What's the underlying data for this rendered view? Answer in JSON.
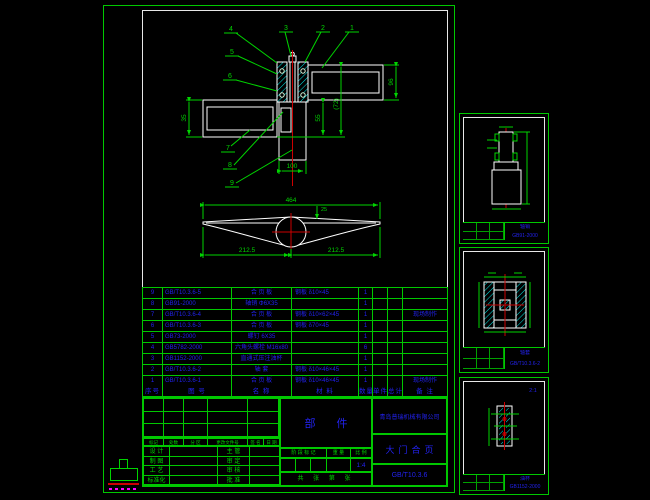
{
  "colors": {
    "background": "#000000",
    "frame_green": "#00c800",
    "annotation_green": "#00d400",
    "geometry_white": "#ffffff",
    "hatch_cyan": "#00e5e5",
    "centerline_red": "#cc0000",
    "table_text_blue": "#2222ee",
    "stamp_magenta": "#ff00ff"
  },
  "main_sheet": {
    "assembly": {
      "callouts": [
        "1",
        "2",
        "3",
        "4",
        "5",
        "6",
        "7",
        "8",
        "9"
      ],
      "dims": {
        "right_bar": "96",
        "overall": "(72)",
        "column": "55",
        "left_bar": "35",
        "bottom": "100"
      }
    },
    "profile": {
      "dims": {
        "overall": "464",
        "offset": "25",
        "half_left": "212.5",
        "half_right": "212.5"
      }
    },
    "parts_table": {
      "headers": [
        "序号",
        "图  号",
        "名  称",
        "材  料",
        "数量",
        "单件",
        "总计",
        "备  注"
      ],
      "rows": [
        {
          "no": "9",
          "code": "GB/T10.3.6-5",
          "name": "合 页 板",
          "material": "钢板  δ10×45",
          "qty": "1",
          "w1": "",
          "w2": "",
          "remark": ""
        },
        {
          "no": "8",
          "code": "GB91-2000",
          "name": "轴销  Φ6X35",
          "material": "",
          "qty": "1",
          "w1": "",
          "w2": "",
          "remark": ""
        },
        {
          "no": "7",
          "code": "GB/T10.3.6-4",
          "name": "合 页 板",
          "material": "钢板  δ10×62×45",
          "qty": "1",
          "w1": "",
          "w2": "",
          "remark": "现场制作"
        },
        {
          "no": "6",
          "code": "GB/T10.3.6-3",
          "name": "合 页 板",
          "material": "钢板  δ70×45",
          "qty": "1",
          "w1": "",
          "w2": "",
          "remark": ""
        },
        {
          "no": "5",
          "code": "GB73-2000",
          "name": "螺钉  6X35",
          "material": "",
          "qty": "1",
          "w1": "",
          "w2": "",
          "remark": ""
        },
        {
          "no": "4",
          "code": "GB5782-2000",
          "name": "六角头螺栓 M16x80",
          "material": "",
          "qty": "6",
          "w1": "",
          "w2": "",
          "remark": ""
        },
        {
          "no": "3",
          "code": "GB1152-2000",
          "name": "直通式压注油杯",
          "material": "",
          "qty": "1",
          "w1": "",
          "w2": "",
          "remark": ""
        },
        {
          "no": "2",
          "code": "GB/T10.3.6-2",
          "name": "轴  套",
          "material": "钢板  δ10×46×45",
          "qty": "1",
          "w1": "",
          "w2": "",
          "remark": ""
        },
        {
          "no": "1",
          "code": "GB/T10.3.6-1",
          "name": "合 页 板",
          "material": "钢板  δ10×46×45",
          "qty": "1",
          "w1": "",
          "w2": "",
          "remark": "现场制作"
        }
      ]
    },
    "title_block": {
      "revision_cols": [
        "标记",
        "处数",
        "分 区",
        "更改文件号",
        "签 名",
        "日 期"
      ],
      "sign_rows": [
        {
          "l": "设 计",
          "r": "主 管"
        },
        {
          "l": "制 图",
          "r": "审 定"
        },
        {
          "l": "工 艺",
          "r": "审 核"
        },
        {
          "l": "标准化",
          "r": "批 准"
        }
      ],
      "doc_type": "部  件",
      "stage_cols": [
        "阶 段 标 记",
        "重 量",
        "比 例"
      ],
      "scale": "1:4",
      "sheet_info": "共  张 第  张",
      "company": "青岛普瑞机械有限公司",
      "drawing_title": "大门合页",
      "drawing_no": "GB/T10.3.6"
    }
  },
  "detail_sheets": [
    {
      "view_label": "",
      "name": "轴销",
      "number": "GB91-2000"
    },
    {
      "view_label": "",
      "name": "轴套",
      "number": "GB/T10.3.6-2"
    },
    {
      "view_label": "2:1",
      "name": "油杯",
      "number": "GB1152-2000"
    }
  ]
}
